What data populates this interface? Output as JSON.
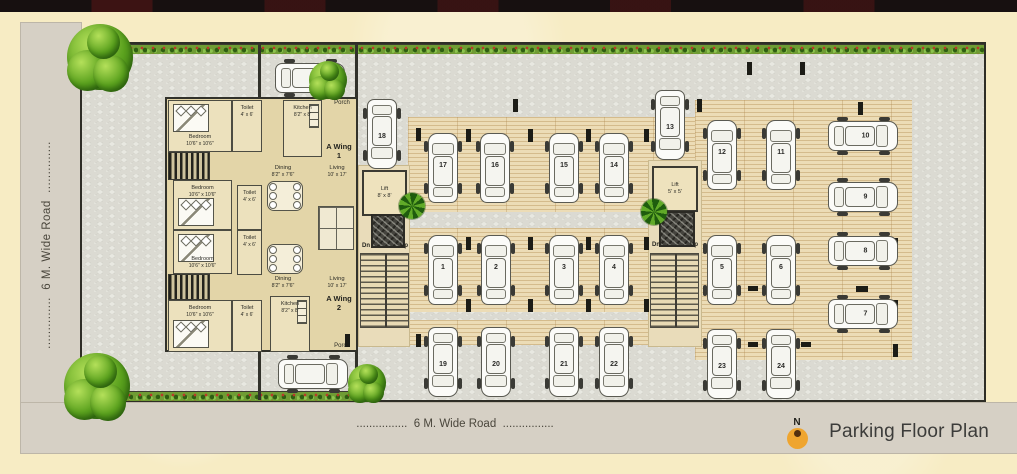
{
  "title": {
    "text": "Parking Floor Plan",
    "north": "N"
  },
  "roads": {
    "left": {
      "label": "6 M. Wide Road",
      "dots_before": "..............",
      "dots_after": ".............."
    },
    "bottom": {
      "label": "6 M. Wide Road",
      "dots_before": "................",
      "dots_after": "................"
    }
  },
  "apartment": {
    "wings": [
      {
        "name": "A Wing",
        "number": "1",
        "x": 322,
        "y": 142,
        "w": 34
      },
      {
        "name": "A Wing",
        "number": "2",
        "x": 322,
        "y": 294,
        "w": 34
      }
    ],
    "porch_labels": [
      {
        "text": "Porch",
        "x": 328,
        "y": 100,
        "w": 28
      },
      {
        "text": "Porch",
        "x": 328,
        "y": 343,
        "w": 28
      }
    ],
    "rooms": [
      {
        "type": "room",
        "label": "Bedroom",
        "dims": "10'6\" x 10'6\"",
        "x": 168,
        "y": 100,
        "w": 64,
        "h": 52,
        "bed": "top"
      },
      {
        "type": "room",
        "label": "Toilet",
        "dims": "4' x 6'",
        "x": 232,
        "y": 100,
        "w": 30,
        "h": 52
      },
      {
        "type": "room",
        "label": "Kitchen",
        "dims": "8'2\" x 8'",
        "x": 283,
        "y": 100,
        "w": 39,
        "h": 57,
        "kitchen": true
      },
      {
        "type": "hatch",
        "x": 168,
        "y": 152,
        "w": 42,
        "h": 28
      },
      {
        "type": "room",
        "label": "Bedroom",
        "dims": "10'6\" x 10'6\"",
        "x": 173,
        "y": 180,
        "w": 59,
        "h": 50,
        "bed": "bottom"
      },
      {
        "type": "room",
        "label": "Toilet",
        "dims": "4' x 6'",
        "x": 237,
        "y": 185,
        "w": 25,
        "h": 45
      },
      {
        "type": "label2",
        "label": "Dining",
        "dims": "8'2\" x 7'6\"",
        "x": 261,
        "y": 161,
        "w": 44,
        "h": 20
      },
      {
        "type": "label2",
        "label": "Living",
        "dims": "10' x 17'",
        "x": 315,
        "y": 161,
        "w": 44,
        "h": 20
      },
      {
        "type": "table",
        "x": 267,
        "y": 181,
        "w": 34,
        "h": 28
      },
      {
        "type": "room",
        "label": "Bedroom",
        "dims": "10'6\" x 10'6\"",
        "x": 173,
        "y": 230,
        "w": 59,
        "h": 44,
        "bed": "top"
      },
      {
        "type": "room",
        "label": "Toilet",
        "dims": "4' x 6'",
        "x": 237,
        "y": 230,
        "w": 25,
        "h": 45
      },
      {
        "type": "hatch",
        "x": 168,
        "y": 274,
        "w": 42,
        "h": 26
      },
      {
        "type": "room",
        "label": "Bedroom",
        "dims": "10'6\" x 10'6\"",
        "x": 168,
        "y": 300,
        "w": 64,
        "h": 52,
        "bed": "bottom"
      },
      {
        "type": "room",
        "label": "Toilet",
        "dims": "4' x 6'",
        "x": 232,
        "y": 300,
        "w": 30,
        "h": 52
      },
      {
        "type": "room",
        "label": "Kitchen",
        "dims": "8'2\" x 8'",
        "x": 270,
        "y": 296,
        "w": 40,
        "h": 56,
        "kitchen": true
      },
      {
        "type": "label2",
        "label": "Dining",
        "dims": "8'2\" x 7'6\"",
        "x": 261,
        "y": 272,
        "w": 44,
        "h": 20
      },
      {
        "type": "label2",
        "label": "Living",
        "dims": "10' x 17'",
        "x": 315,
        "y": 272,
        "w": 44,
        "h": 20
      },
      {
        "type": "table",
        "x": 267,
        "y": 244,
        "w": 34,
        "h": 28
      },
      {
        "type": "furn",
        "x": 318,
        "y": 206,
        "w": 34,
        "h": 42
      }
    ]
  },
  "lifts": [
    {
      "name": "Lift",
      "dims": "8' x 8'",
      "x": 362,
      "y": 170,
      "w": 45,
      "h": 46
    },
    {
      "name": "Lift",
      "dims": "5' x 5'",
      "x": 652,
      "y": 166,
      "w": 46,
      "h": 46
    }
  ],
  "stairwells": [
    {
      "dn": "Dn",
      "up": "Up",
      "core": {
        "x": 371,
        "y": 214,
        "w": 34,
        "h": 34
      },
      "labels": {
        "x": 362,
        "y": 243,
        "w": 46
      },
      "ladder": {
        "x": 360,
        "y": 253,
        "w": 49,
        "h": 75
      }
    },
    {
      "dn": "Dn",
      "up": "Up",
      "core": {
        "x": 659,
        "y": 211,
        "w": 36,
        "h": 36
      },
      "labels": {
        "x": 652,
        "y": 242,
        "w": 46
      },
      "ladder": {
        "x": 650,
        "y": 253,
        "w": 49,
        "h": 75
      }
    }
  ],
  "parking": {
    "strips": [
      {
        "x": 408,
        "y": 117,
        "w": 292,
        "h": 95
      },
      {
        "x": 408,
        "y": 228,
        "w": 292,
        "h": 84
      },
      {
        "x": 695,
        "y": 100,
        "w": 217,
        "h": 260
      },
      {
        "x": 408,
        "y": 320,
        "w": 292,
        "h": 25
      }
    ],
    "corridors": [
      {
        "x": 358,
        "y": 165,
        "w": 50,
        "h": 180
      },
      {
        "x": 648,
        "y": 160,
        "w": 52,
        "h": 185
      }
    ],
    "spots": [
      {
        "n": "18",
        "x": 382,
        "y": 134,
        "dir": "up"
      },
      {
        "n": "17",
        "x": 443,
        "y": 168,
        "dir": "down"
      },
      {
        "n": "16",
        "x": 495,
        "y": 168,
        "dir": "down"
      },
      {
        "n": "15",
        "x": 564,
        "y": 168,
        "dir": "down"
      },
      {
        "n": "14",
        "x": 614,
        "y": 168,
        "dir": "down"
      },
      {
        "n": "13",
        "x": 670,
        "y": 125,
        "dir": "up"
      },
      {
        "n": "12",
        "x": 722,
        "y": 155,
        "dir": "down"
      },
      {
        "n": "11",
        "x": 781,
        "y": 155,
        "dir": "down"
      },
      {
        "n": "10",
        "x": 863,
        "y": 136,
        "dir": "left"
      },
      {
        "n": "9",
        "x": 863,
        "y": 197,
        "dir": "left"
      },
      {
        "n": "1",
        "x": 443,
        "y": 270,
        "dir": "down"
      },
      {
        "n": "2",
        "x": 496,
        "y": 270,
        "dir": "down"
      },
      {
        "n": "3",
        "x": 564,
        "y": 270,
        "dir": "down"
      },
      {
        "n": "4",
        "x": 614,
        "y": 270,
        "dir": "down"
      },
      {
        "n": "5",
        "x": 722,
        "y": 270,
        "dir": "down"
      },
      {
        "n": "6",
        "x": 781,
        "y": 270,
        "dir": "down"
      },
      {
        "n": "8",
        "x": 863,
        "y": 251,
        "dir": "left"
      },
      {
        "n": "7",
        "x": 863,
        "y": 314,
        "dir": "left"
      },
      {
        "n": "19",
        "x": 443,
        "y": 362,
        "dir": "up"
      },
      {
        "n": "20",
        "x": 496,
        "y": 362,
        "dir": "up"
      },
      {
        "n": "21",
        "x": 564,
        "y": 362,
        "dir": "up"
      },
      {
        "n": "22",
        "x": 614,
        "y": 362,
        "dir": "up"
      },
      {
        "n": "23",
        "x": 722,
        "y": 364,
        "dir": "up"
      },
      {
        "n": "24",
        "x": 781,
        "y": 364,
        "dir": "up"
      }
    ],
    "porch_cars": [
      {
        "x": 310,
        "y": 78,
        "dir": "left"
      },
      {
        "x": 313,
        "y": 374,
        "dir": "left"
      }
    ]
  },
  "columns": [
    [
      513,
      99
    ],
    [
      697,
      99
    ],
    [
      858,
      102
    ],
    [
      416,
      128
    ],
    [
      466,
      129
    ],
    [
      528,
      129
    ],
    [
      586,
      129
    ],
    [
      644,
      129
    ],
    [
      856,
      129
    ],
    [
      416,
      196
    ],
    [
      856,
      194
    ],
    [
      466,
      237
    ],
    [
      528,
      237
    ],
    [
      586,
      237
    ],
    [
      644,
      237
    ],
    [
      893,
      238
    ],
    [
      466,
      299
    ],
    [
      528,
      299
    ],
    [
      586,
      299
    ],
    [
      644,
      299
    ],
    [
      893,
      300
    ],
    [
      747,
      62
    ],
    [
      800,
      62
    ],
    [
      748,
      286,
      10,
      5
    ],
    [
      748,
      342,
      10,
      5
    ],
    [
      801,
      342,
      10,
      5
    ],
    [
      856,
      286,
      12,
      6
    ],
    [
      893,
      344
    ],
    [
      416,
      334
    ],
    [
      345,
      334
    ]
  ],
  "walls": [
    {
      "x": 258,
      "y": 44,
      "w": 3,
      "h": 54
    },
    {
      "x": 355,
      "y": 44,
      "w": 3,
      "h": 54
    },
    {
      "x": 258,
      "y": 352,
      "w": 3,
      "h": 48
    },
    {
      "x": 355,
      "y": 352,
      "w": 3,
      "h": 46
    }
  ],
  "trees": {
    "large": [
      [
        100,
        57
      ],
      [
        97,
        386
      ]
    ],
    "small": [
      [
        328,
        80
      ],
      [
        367,
        383
      ]
    ],
    "palms": [
      [
        412,
        206
      ],
      [
        654,
        212
      ]
    ]
  },
  "colors": {
    "accent_orange": "#efa52f",
    "hedge_green": "#6f9c34",
    "paving_tan": "#ecdcb6",
    "cobble_gray": "#dbdad2",
    "road_gray": "#d6d0c5",
    "background_cream": "#f7ecc4"
  }
}
